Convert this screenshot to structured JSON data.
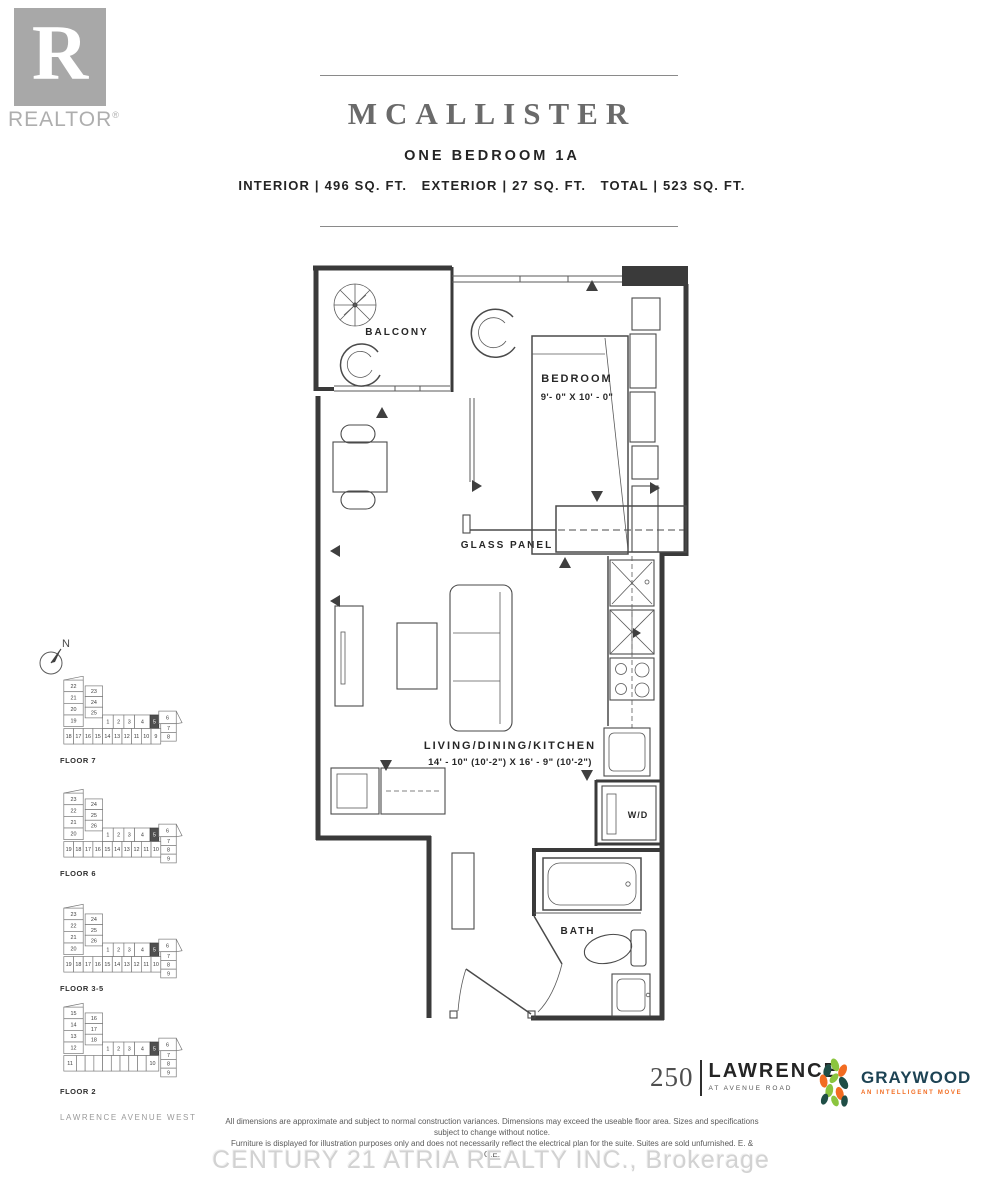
{
  "header": {
    "realtor_letter": "R",
    "realtor_label": "REALTOR",
    "realtor_reg": "®",
    "title": "MCALLISTER",
    "subtitle": "ONE BEDROOM 1A",
    "stats": "INTERIOR | 496 SQ. FT.   EXTERIOR | 27 SQ. FT.   TOTAL | 523 SQ. FT."
  },
  "plan": {
    "balcony_label": "BALCONY",
    "bedroom_label": "BEDROOM",
    "bedroom_dims": "9'- 0\" X 10' - 0\"",
    "glass_panel_label": "GLASS PANEL",
    "living_label": "LIVING/DINING/KITCHEN",
    "living_dims": "14' - 10\" (10'-2\") X 16' - 9\" (10'-2\")",
    "wd_label": "W/D",
    "bath_label": "BATH"
  },
  "sidebar": {
    "compass_n": "N",
    "street_label": "LAWRENCE AVENUE WEST",
    "floors": [
      {
        "label": "FLOOR 7",
        "cells": [
          {
            "x": 6,
            "y": 4,
            "w": 20,
            "h": 12,
            "t": "22"
          },
          {
            "x": 6,
            "y": 16,
            "w": 20,
            "h": 12,
            "t": "21"
          },
          {
            "x": 6,
            "y": 28,
            "w": 20,
            "h": 12,
            "t": "20"
          },
          {
            "x": 6,
            "y": 40,
            "w": 20,
            "h": 12,
            "t": "19"
          },
          {
            "x": 28,
            "y": 10,
            "w": 18,
            "h": 11,
            "t": "23"
          },
          {
            "x": 28,
            "y": 21,
            "w": 18,
            "h": 11,
            "t": "24"
          },
          {
            "x": 28,
            "y": 32,
            "w": 18,
            "h": 11,
            "t": "25"
          },
          {
            "x": 46,
            "y": 40,
            "w": 11,
            "h": 14,
            "t": "1"
          },
          {
            "x": 57,
            "y": 40,
            "w": 11,
            "h": 14,
            "t": "2"
          },
          {
            "x": 68,
            "y": 40,
            "w": 11,
            "h": 14,
            "t": "3"
          },
          {
            "x": 79,
            "y": 40,
            "w": 16,
            "h": 14,
            "t": "4"
          },
          {
            "x": 95,
            "y": 40,
            "w": 9,
            "h": 14,
            "t": "5",
            "hl": true
          },
          {
            "x": 104,
            "y": 36,
            "w": 18,
            "h": 13,
            "t": "6"
          },
          {
            "x": 106,
            "y": 49,
            "w": 16,
            "h": 9,
            "t": "7"
          },
          {
            "x": 106,
            "y": 58,
            "w": 16,
            "h": 9,
            "t": "8"
          },
          {
            "x": 6,
            "y": 54,
            "w": 10,
            "h": 16,
            "t": "18"
          },
          {
            "x": 16,
            "y": 54,
            "w": 10,
            "h": 16,
            "t": "17"
          },
          {
            "x": 26,
            "y": 54,
            "w": 10,
            "h": 16,
            "t": "16"
          },
          {
            "x": 36,
            "y": 54,
            "w": 10,
            "h": 16,
            "t": "15"
          },
          {
            "x": 46,
            "y": 54,
            "w": 10,
            "h": 16,
            "t": "14"
          },
          {
            "x": 56,
            "y": 54,
            "w": 10,
            "h": 16,
            "t": "13"
          },
          {
            "x": 66,
            "y": 54,
            "w": 10,
            "h": 16,
            "t": "12"
          },
          {
            "x": 76,
            "y": 54,
            "w": 10,
            "h": 16,
            "t": "11"
          },
          {
            "x": 86,
            "y": 54,
            "w": 10,
            "h": 16,
            "t": "10"
          },
          {
            "x": 96,
            "y": 54,
            "w": 10,
            "h": 16,
            "t": "9"
          }
        ]
      },
      {
        "label": "FLOOR 6",
        "cells": [
          {
            "x": 6,
            "y": 4,
            "w": 20,
            "h": 12,
            "t": "23"
          },
          {
            "x": 6,
            "y": 16,
            "w": 20,
            "h": 12,
            "t": "22"
          },
          {
            "x": 6,
            "y": 28,
            "w": 20,
            "h": 12,
            "t": "21"
          },
          {
            "x": 6,
            "y": 40,
            "w": 20,
            "h": 12,
            "t": "20"
          },
          {
            "x": 28,
            "y": 10,
            "w": 18,
            "h": 11,
            "t": "24"
          },
          {
            "x": 28,
            "y": 21,
            "w": 18,
            "h": 11,
            "t": "25"
          },
          {
            "x": 28,
            "y": 32,
            "w": 18,
            "h": 11,
            "t": "26"
          },
          {
            "x": 46,
            "y": 40,
            "w": 11,
            "h": 14,
            "t": "1"
          },
          {
            "x": 57,
            "y": 40,
            "w": 11,
            "h": 14,
            "t": "2"
          },
          {
            "x": 68,
            "y": 40,
            "w": 11,
            "h": 14,
            "t": "3"
          },
          {
            "x": 79,
            "y": 40,
            "w": 16,
            "h": 14,
            "t": "4"
          },
          {
            "x": 95,
            "y": 40,
            "w": 9,
            "h": 14,
            "t": "5",
            "hl": true
          },
          {
            "x": 104,
            "y": 36,
            "w": 18,
            "h": 13,
            "t": "6"
          },
          {
            "x": 106,
            "y": 49,
            "w": 16,
            "h": 9,
            "t": "7"
          },
          {
            "x": 106,
            "y": 58,
            "w": 16,
            "h": 9,
            "t": "8"
          },
          {
            "x": 106,
            "y": 67,
            "w": 16,
            "h": 9,
            "t": "9"
          },
          {
            "x": 6,
            "y": 54,
            "w": 10,
            "h": 16,
            "t": "19"
          },
          {
            "x": 16,
            "y": 54,
            "w": 10,
            "h": 16,
            "t": "18"
          },
          {
            "x": 26,
            "y": 54,
            "w": 10,
            "h": 16,
            "t": "17"
          },
          {
            "x": 36,
            "y": 54,
            "w": 10,
            "h": 16,
            "t": "16"
          },
          {
            "x": 46,
            "y": 54,
            "w": 10,
            "h": 16,
            "t": "15"
          },
          {
            "x": 56,
            "y": 54,
            "w": 10,
            "h": 16,
            "t": "14"
          },
          {
            "x": 66,
            "y": 54,
            "w": 10,
            "h": 16,
            "t": "13"
          },
          {
            "x": 76,
            "y": 54,
            "w": 10,
            "h": 16,
            "t": "12"
          },
          {
            "x": 86,
            "y": 54,
            "w": 10,
            "h": 16,
            "t": "11"
          },
          {
            "x": 96,
            "y": 54,
            "w": 10,
            "h": 16,
            "t": "10"
          }
        ]
      },
      {
        "label": "FLOOR 3-5",
        "cells": [
          {
            "x": 6,
            "y": 4,
            "w": 20,
            "h": 12,
            "t": "23"
          },
          {
            "x": 6,
            "y": 16,
            "w": 20,
            "h": 12,
            "t": "22"
          },
          {
            "x": 6,
            "y": 28,
            "w": 20,
            "h": 12,
            "t": "21"
          },
          {
            "x": 6,
            "y": 40,
            "w": 20,
            "h": 12,
            "t": "20"
          },
          {
            "x": 28,
            "y": 10,
            "w": 18,
            "h": 11,
            "t": "24"
          },
          {
            "x": 28,
            "y": 21,
            "w": 18,
            "h": 11,
            "t": "25"
          },
          {
            "x": 28,
            "y": 32,
            "w": 18,
            "h": 11,
            "t": "26"
          },
          {
            "x": 46,
            "y": 40,
            "w": 11,
            "h": 14,
            "t": "1"
          },
          {
            "x": 57,
            "y": 40,
            "w": 11,
            "h": 14,
            "t": "2"
          },
          {
            "x": 68,
            "y": 40,
            "w": 11,
            "h": 14,
            "t": "3"
          },
          {
            "x": 79,
            "y": 40,
            "w": 16,
            "h": 14,
            "t": "4"
          },
          {
            "x": 95,
            "y": 40,
            "w": 9,
            "h": 14,
            "t": "5",
            "hl": true
          },
          {
            "x": 104,
            "y": 36,
            "w": 18,
            "h": 13,
            "t": "6"
          },
          {
            "x": 106,
            "y": 49,
            "w": 16,
            "h": 9,
            "t": "7"
          },
          {
            "x": 106,
            "y": 58,
            "w": 16,
            "h": 9,
            "t": "8"
          },
          {
            "x": 106,
            "y": 67,
            "w": 16,
            "h": 9,
            "t": "9"
          },
          {
            "x": 6,
            "y": 54,
            "w": 10,
            "h": 16,
            "t": "19"
          },
          {
            "x": 16,
            "y": 54,
            "w": 10,
            "h": 16,
            "t": "18"
          },
          {
            "x": 26,
            "y": 54,
            "w": 10,
            "h": 16,
            "t": "17"
          },
          {
            "x": 36,
            "y": 54,
            "w": 10,
            "h": 16,
            "t": "16"
          },
          {
            "x": 46,
            "y": 54,
            "w": 10,
            "h": 16,
            "t": "15"
          },
          {
            "x": 56,
            "y": 54,
            "w": 10,
            "h": 16,
            "t": "14"
          },
          {
            "x": 66,
            "y": 54,
            "w": 10,
            "h": 16,
            "t": "13"
          },
          {
            "x": 76,
            "y": 54,
            "w": 10,
            "h": 16,
            "t": "12"
          },
          {
            "x": 86,
            "y": 54,
            "w": 10,
            "h": 16,
            "t": "11"
          },
          {
            "x": 96,
            "y": 54,
            "w": 10,
            "h": 16,
            "t": "10"
          }
        ]
      },
      {
        "label": "FLOOR 2",
        "cells": [
          {
            "x": 6,
            "y": 4,
            "w": 20,
            "h": 12,
            "t": "15"
          },
          {
            "x": 6,
            "y": 16,
            "w": 20,
            "h": 12,
            "t": "14"
          },
          {
            "x": 6,
            "y": 28,
            "w": 20,
            "h": 12,
            "t": "13"
          },
          {
            "x": 6,
            "y": 40,
            "w": 20,
            "h": 12,
            "t": "12"
          },
          {
            "x": 28,
            "y": 10,
            "w": 18,
            "h": 11,
            "t": "16"
          },
          {
            "x": 28,
            "y": 21,
            "w": 18,
            "h": 11,
            "t": "17"
          },
          {
            "x": 28,
            "y": 32,
            "w": 18,
            "h": 11,
            "t": "18"
          },
          {
            "x": 46,
            "y": 40,
            "w": 11,
            "h": 14,
            "t": "1"
          },
          {
            "x": 57,
            "y": 40,
            "w": 11,
            "h": 14,
            "t": "2"
          },
          {
            "x": 68,
            "y": 40,
            "w": 11,
            "h": 14,
            "t": "3"
          },
          {
            "x": 79,
            "y": 40,
            "w": 16,
            "h": 14,
            "t": "4"
          },
          {
            "x": 95,
            "y": 40,
            "w": 9,
            "h": 14,
            "t": "5",
            "hl": true
          },
          {
            "x": 104,
            "y": 36,
            "w": 18,
            "h": 13,
            "t": "6"
          },
          {
            "x": 106,
            "y": 49,
            "w": 16,
            "h": 9,
            "t": "7"
          },
          {
            "x": 106,
            "y": 58,
            "w": 16,
            "h": 9,
            "t": "8"
          },
          {
            "x": 106,
            "y": 67,
            "w": 16,
            "h": 9,
            "t": "9"
          },
          {
            "x": 6,
            "y": 54,
            "w": 13,
            "h": 16,
            "t": "11"
          },
          {
            "x": 19,
            "y": 54,
            "w": 9,
            "h": 16,
            "t": ""
          },
          {
            "x": 28,
            "y": 54,
            "w": 9,
            "h": 16,
            "t": ""
          },
          {
            "x": 37,
            "y": 54,
            "w": 9,
            "h": 16,
            "t": ""
          },
          {
            "x": 46,
            "y": 54,
            "w": 9,
            "h": 16,
            "t": ""
          },
          {
            "x": 55,
            "y": 54,
            "w": 9,
            "h": 16,
            "t": ""
          },
          {
            "x": 64,
            "y": 54,
            "w": 9,
            "h": 16,
            "t": ""
          },
          {
            "x": 73,
            "y": 54,
            "w": 9,
            "h": 16,
            "t": ""
          },
          {
            "x": 82,
            "y": 54,
            "w": 9,
            "h": 16,
            "t": ""
          },
          {
            "x": 91,
            "y": 54,
            "w": 13,
            "h": 16,
            "t": "10"
          }
        ]
      }
    ]
  },
  "footer": {
    "disclaimer_line1": "All dimensions are approximate and subject to normal construction variances. Dimensions may exceed the useable floor area. Sizes and specifications subject to change without notice.",
    "disclaimer_line2": "Furniture is displayed for illustration purposes only and does not necessarily reflect the electrical plan for the suite. Suites are sold unfurnished. E. & O.E.",
    "watermark": "CENTURY 21 ATRIA REALTY INC., Brokerage",
    "lawrence_number": "250",
    "lawrence_name": "LAWRENCE",
    "lawrence_tagline": "AT AVENUE ROAD",
    "graywood_name": "GRAYWOOD",
    "graywood_tagline": "AN INTELLIGENT MOVE"
  },
  "colors": {
    "realtor-gray": "#a8a8a8",
    "title-gray": "#6a6a6a",
    "graywood-navy": "#1d4354",
    "graywood-orange": "#f26c21",
    "graywood-green": "#8bc53f",
    "graywood-teal": "#1f4e46",
    "watermark-gray": "#d2d2d2"
  }
}
